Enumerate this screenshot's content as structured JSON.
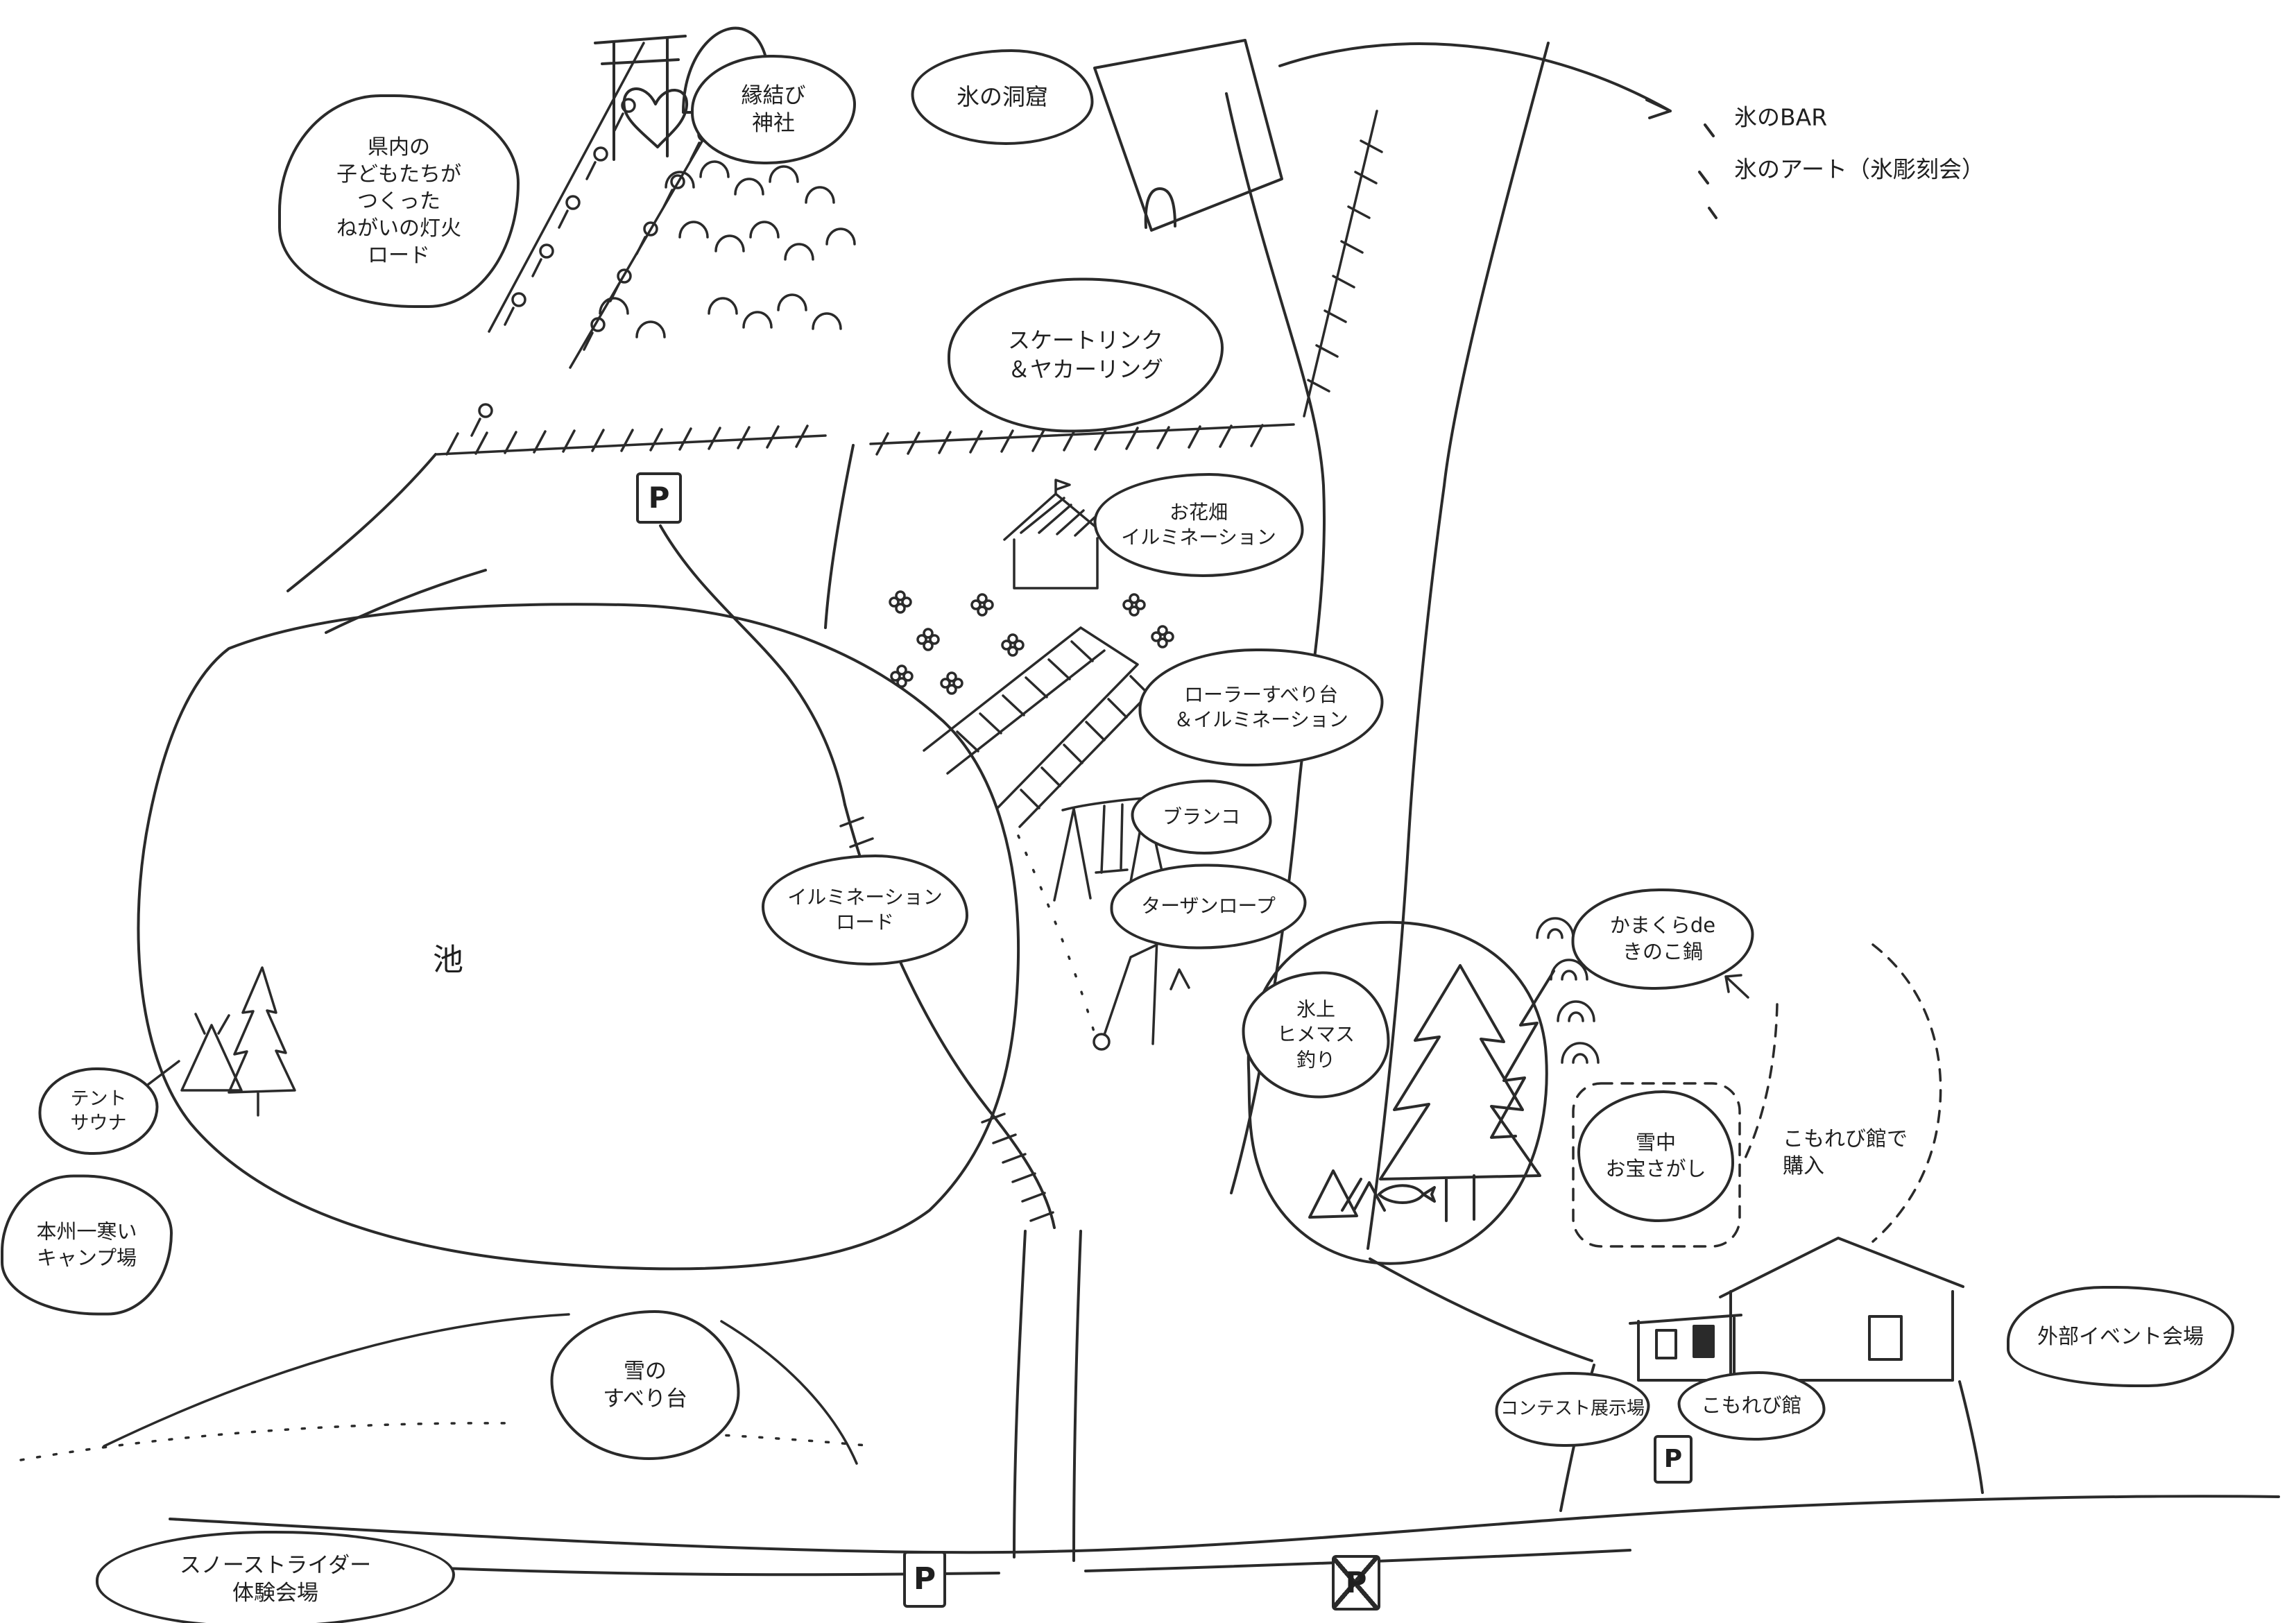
{
  "page": {
    "title": "冬イベント会場 手書きマップ",
    "background": "#ffffff",
    "ink": "#2a2a2a"
  },
  "map": {
    "labels": [
      {
        "id": "wish-lantern-road",
        "text": "県内の\n子どもたちが\nつくった\nねがいの灯火\nロード"
      },
      {
        "id": "enmusubi-shrine",
        "text": "縁結び\n神社"
      },
      {
        "id": "ice-cave",
        "text": "氷の洞窟"
      },
      {
        "id": "ice-bar",
        "text": "氷のBAR"
      },
      {
        "id": "ice-art",
        "text": "氷のアート（氷彫刻会）"
      },
      {
        "id": "skate-rink",
        "text": "スケートリンク\n＆ヤカーリング"
      },
      {
        "id": "flower-illumination",
        "text": "お花畑\nイルミネーション"
      },
      {
        "id": "roller-slide",
        "text": "ローラーすべり台\n＆イルミネーション"
      },
      {
        "id": "swing",
        "text": "ブランコ"
      },
      {
        "id": "tarzan-rope",
        "text": "ターザンロープ"
      },
      {
        "id": "illumination-road",
        "text": "イルミネーション\nロード"
      },
      {
        "id": "pond",
        "text": "池"
      },
      {
        "id": "tent-sauna",
        "text": "テント\nサウナ"
      },
      {
        "id": "coldest-camp",
        "text": "本州一寒い\nキャンプ場"
      },
      {
        "id": "snow-slide",
        "text": "雪の\nすべり台"
      },
      {
        "id": "snow-strider",
        "text": "スノーストライダー\n体験会場"
      },
      {
        "id": "ice-fishing",
        "text": "氷上\nヒメマス\n釣り"
      },
      {
        "id": "kamakura-nabe",
        "text": "かまくらde\nきのこ鍋"
      },
      {
        "id": "treasure-hunt",
        "text": "雪中\nお宝さがし"
      },
      {
        "id": "purchase-note",
        "text": "こもれび館で\n購入"
      },
      {
        "id": "contest-hall",
        "text": "コンテスト展示場"
      },
      {
        "id": "komorebi-hall",
        "text": "こもれび館"
      },
      {
        "id": "outside-event",
        "text": "外部イベント会場"
      },
      {
        "id": "parking-north",
        "text": "P"
      },
      {
        "id": "parking-south",
        "text": "P"
      },
      {
        "id": "parking-closed",
        "text": "P"
      },
      {
        "id": "parking-komorebi",
        "text": "P"
      }
    ]
  }
}
